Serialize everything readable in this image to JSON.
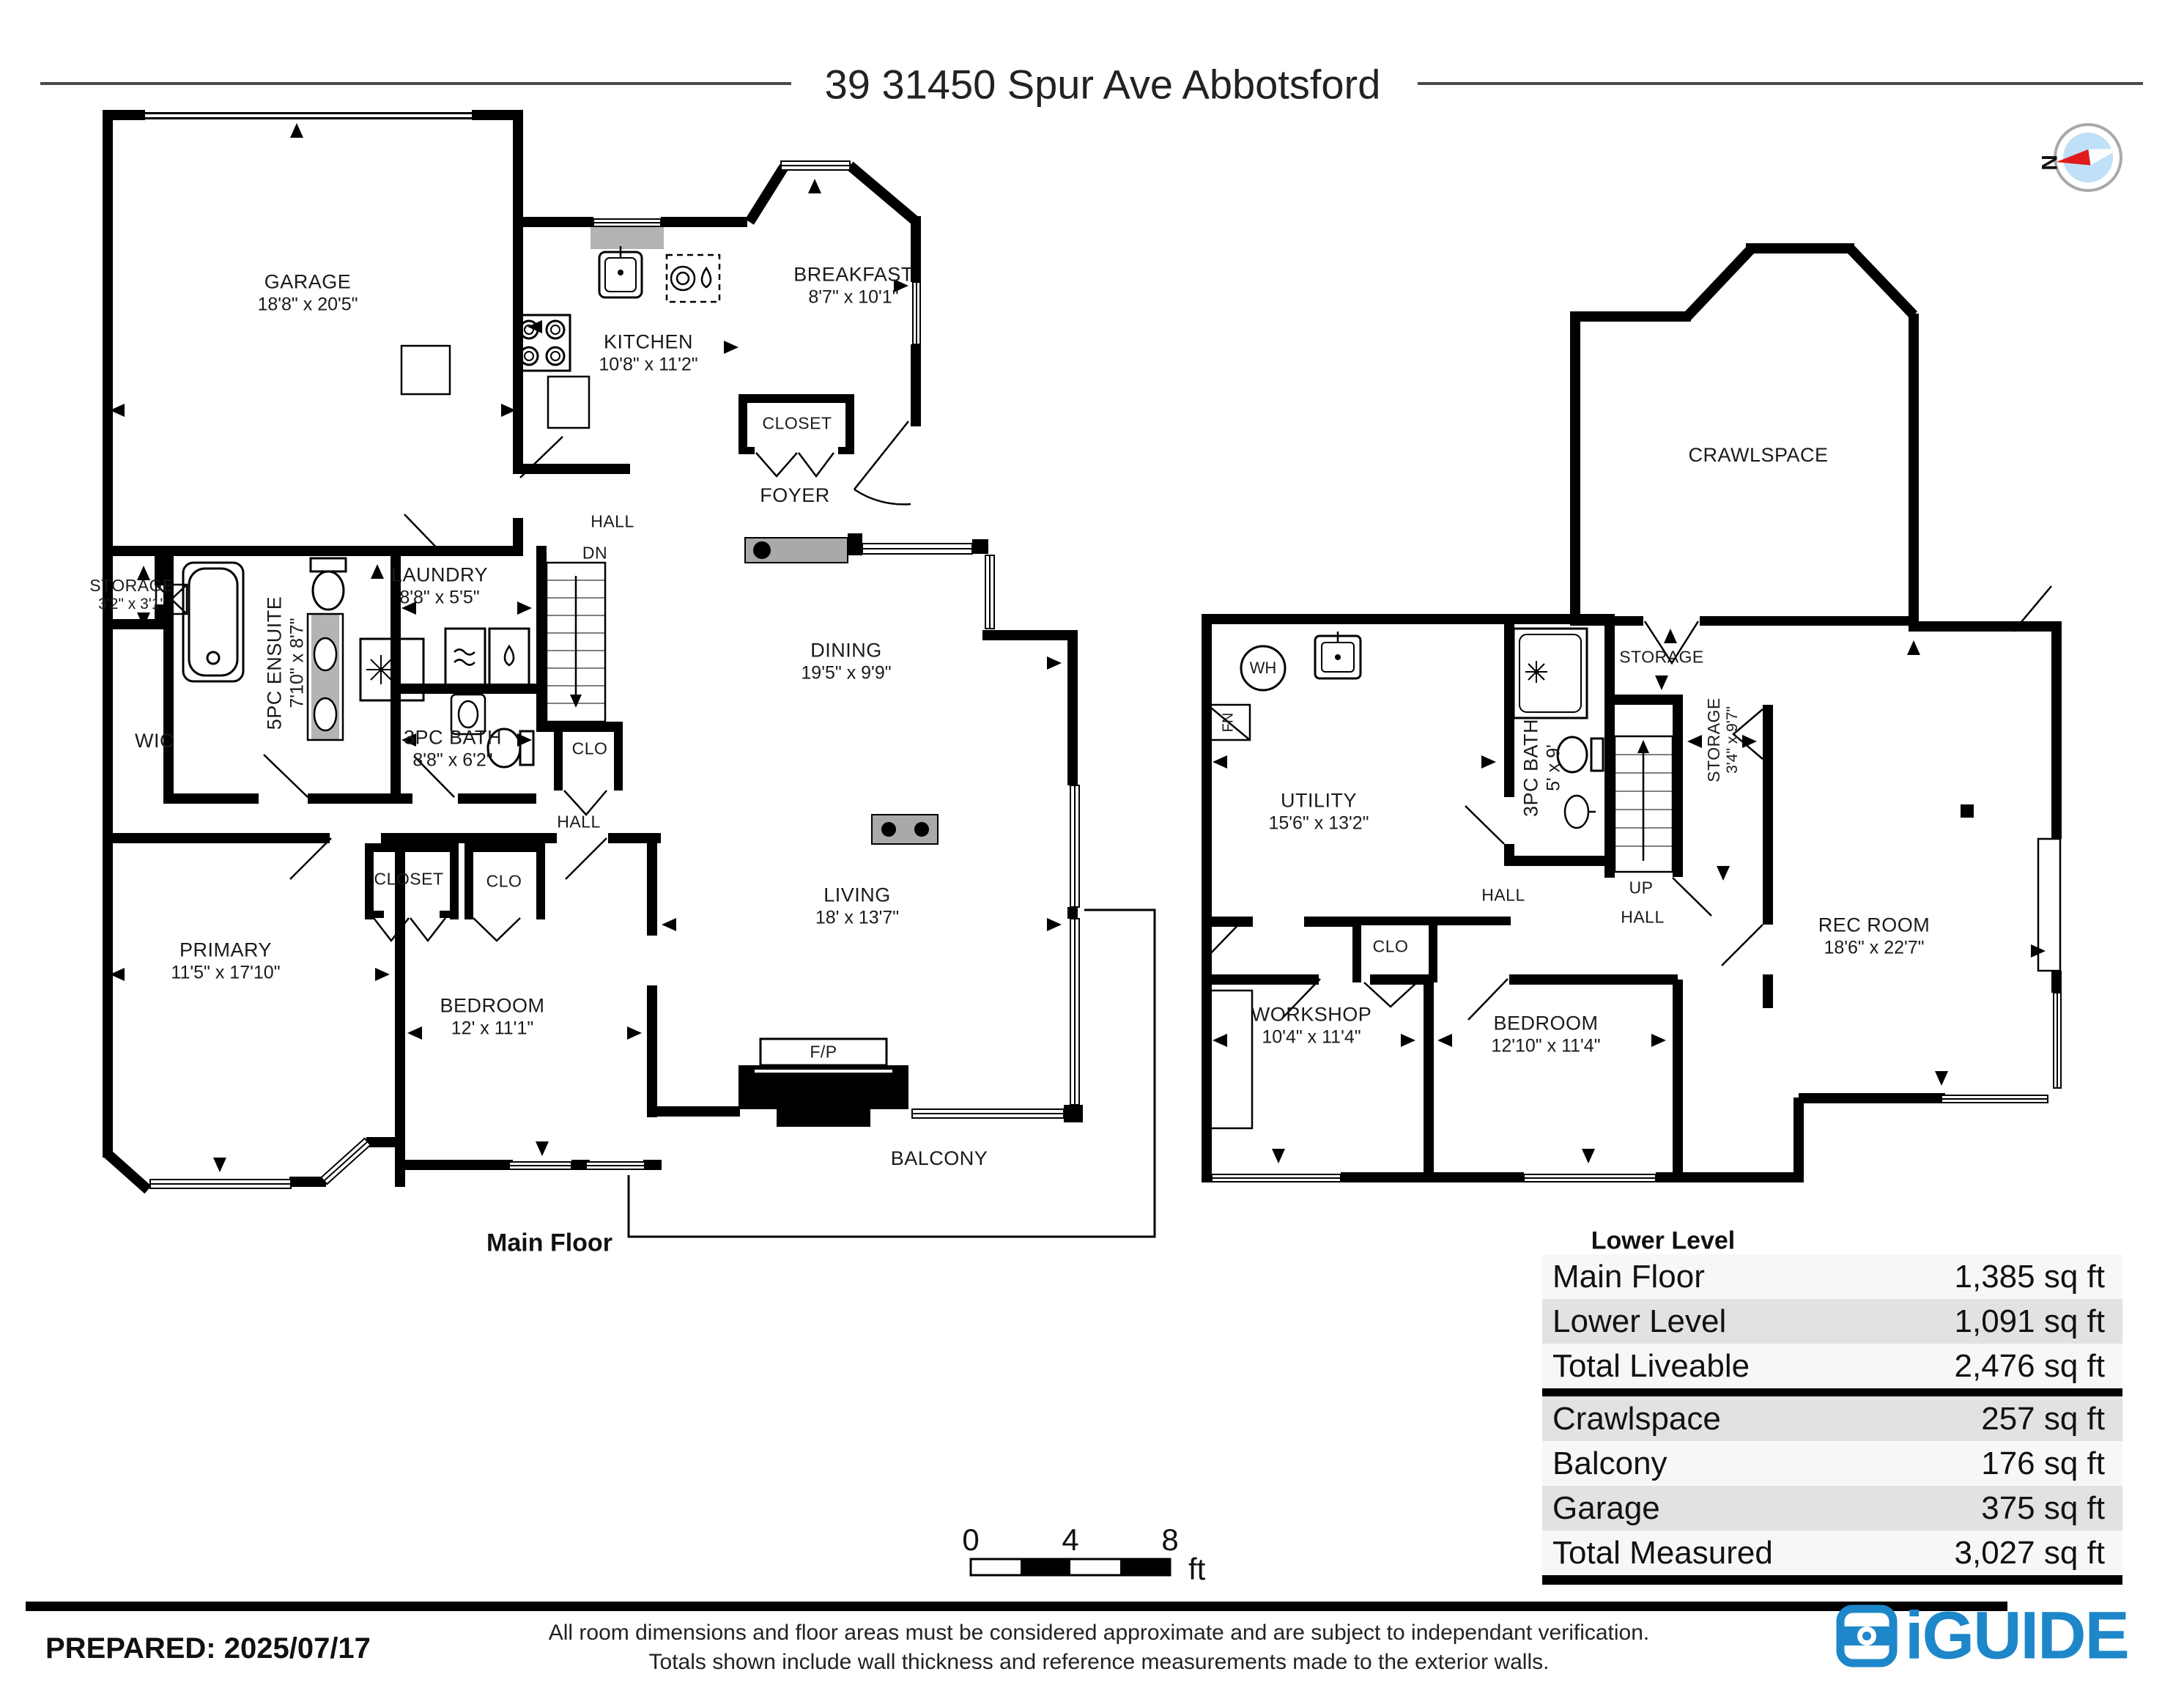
{
  "title": "39 31450 Spur Ave Abbotsford",
  "compass": {
    "north": "N"
  },
  "main_floor": {
    "caption": "Main Floor",
    "labels": {
      "garage": {
        "name": "GARAGE",
        "dims": "18'8\" x 20'5\""
      },
      "kitchen": {
        "name": "KITCHEN",
        "dims": "10'8\" x 11'2\""
      },
      "breakfast": {
        "name": "BREAKFAST",
        "dims": "8'7\" x 10'1\""
      },
      "closet_foyer": {
        "name": "CLOSET"
      },
      "foyer": {
        "name": "FOYER"
      },
      "hall_top": {
        "name": "HALL"
      },
      "dn": {
        "name": "DN"
      },
      "storage": {
        "name": "STORAGE",
        "dims": "3'2\" x 3'1\""
      },
      "ensuite": {
        "name": "5PC ENSUITE",
        "dims": "7'10\" x 8'7\""
      },
      "laundry": {
        "name": "LAUNDRY",
        "dims": "8'8\" x 5'5\""
      },
      "bath": {
        "name": "3PC BATH",
        "dims": "8'8\" x 6'2\""
      },
      "wic": {
        "name": "WIC"
      },
      "clo_stairs": {
        "name": "CLO"
      },
      "hall_bottom": {
        "name": "HALL"
      },
      "dining": {
        "name": "DINING",
        "dims": "19'5\" x 9'9\""
      },
      "closet_primary": {
        "name": "CLOSET"
      },
      "clo_bedroom": {
        "name": "CLO"
      },
      "primary": {
        "name": "PRIMARY",
        "dims": "11'5\" x 17'10\""
      },
      "bedroom": {
        "name": "BEDROOM",
        "dims": "12' x 11'1\""
      },
      "living": {
        "name": "LIVING",
        "dims": "18' x 13'7\""
      },
      "fp": {
        "name": "F/P"
      },
      "balcony": {
        "name": "BALCONY"
      }
    }
  },
  "lower_level": {
    "caption": "Lower Level",
    "labels": {
      "crawlspace": {
        "name": "CRAWLSPACE"
      },
      "wh": {
        "name": "WH"
      },
      "fn": {
        "name": "FN"
      },
      "utility": {
        "name": "UTILITY",
        "dims": "15'6\" x 13'2\""
      },
      "bath": {
        "name": "3PC BATH",
        "dims": "5' x 9'"
      },
      "storage_landing": {
        "name": "STORAGE"
      },
      "storage2": {
        "name": "STORAGE",
        "dims": "3'4\" x 9'7\""
      },
      "up": {
        "name": "UP"
      },
      "hall_left": {
        "name": "HALL"
      },
      "hall_right": {
        "name": "HALL"
      },
      "clo": {
        "name": "CLO"
      },
      "workshop": {
        "name": "WORKSHOP",
        "dims": "10'4\" x 11'4\""
      },
      "bedroom": {
        "name": "BEDROOM",
        "dims": "12'10\" x 11'4\""
      },
      "rec": {
        "name": "REC ROOM",
        "dims": "18'6\" x 22'7\""
      }
    }
  },
  "area_table": {
    "rows": [
      {
        "label": "Main Floor",
        "value": "1,385 sq ft"
      },
      {
        "label": "Lower Level",
        "value": "1,091 sq ft"
      },
      {
        "label": "Total Liveable",
        "value": "2,476 sq ft"
      },
      {
        "label": "Crawlspace",
        "value": "257 sq ft"
      },
      {
        "label": "Balcony",
        "value": "176 sq ft"
      },
      {
        "label": "Garage",
        "value": "375 sq ft"
      },
      {
        "label": "Total Measured",
        "value": "3,027 sq ft"
      }
    ]
  },
  "scale_bar": {
    "t0": "0",
    "t4": "4",
    "t8": "8",
    "unit": "ft"
  },
  "footer": {
    "prepared": "PREPARED: 2025/07/17",
    "line1": "All room dimensions and floor areas must be considered approximate and are subject to independant verification.",
    "line2": "Totals shown include wall thickness and reference measurements made to the exterior walls."
  },
  "logo": {
    "text": "iGUIDE"
  }
}
